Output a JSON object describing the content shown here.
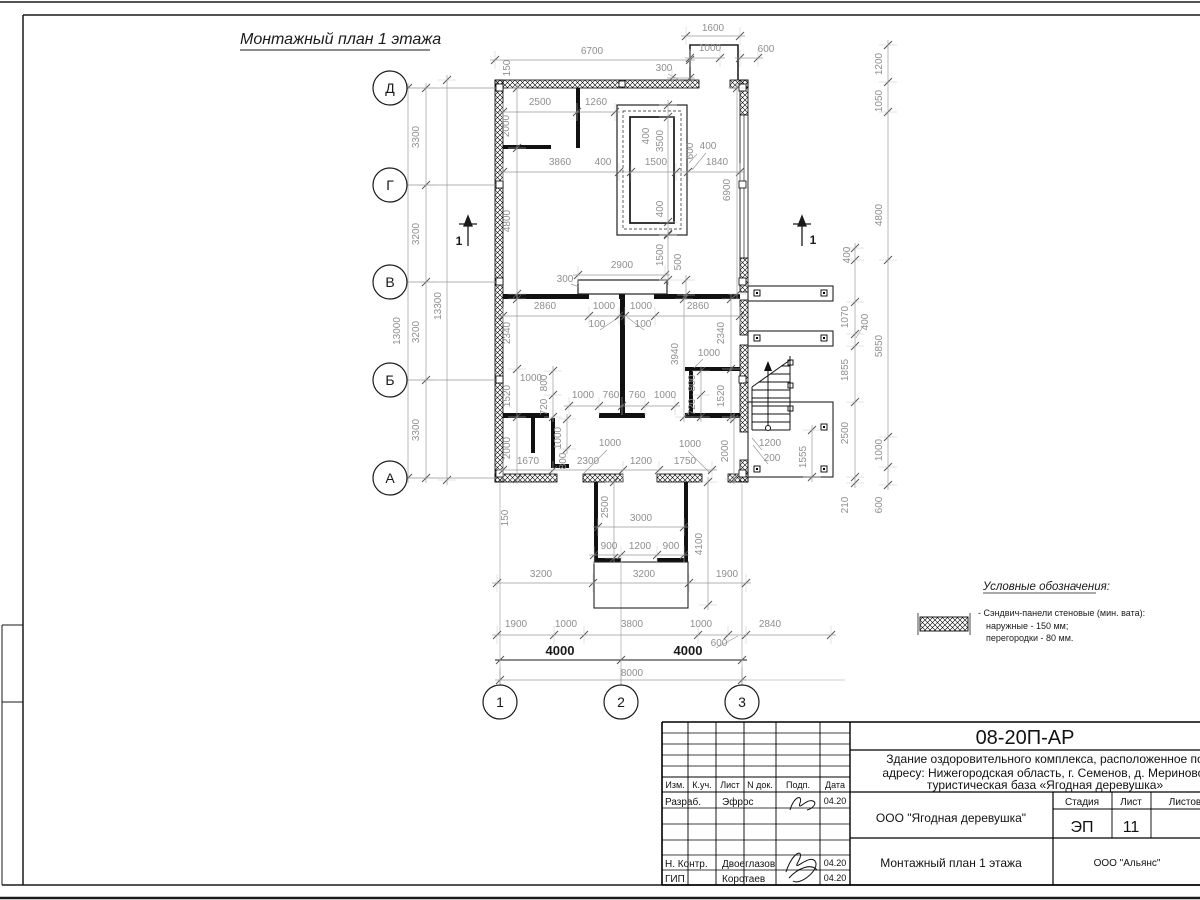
{
  "sheet": {
    "title": "Монтажный план 1 этажа"
  },
  "legend": {
    "title": "Условные обозначения:",
    "item": "- Сэндвич-панели стеновые (мин. вата):",
    "line2": "наружные - 150 мм;",
    "line3": "перегородки - 80 мм."
  },
  "title_block": {
    "code": "08-20П-АР",
    "desc1": "Здание оздоровительного комплекса, расположенное по",
    "desc2": "адресу: Нижегородская область, г. Семенов, д. Мериново,",
    "desc3": "туристическая база «Ягодная деревушка»",
    "cols": {
      "izm": "Изм.",
      "kuch": "К.уч.",
      "list": "Лист",
      "ndok": "N док.",
      "podp": "Подп.",
      "data": "Дата"
    },
    "rows": {
      "razrab": "Разраб.",
      "nkontr": "Н. Контр.",
      "gip": "ГИП"
    },
    "names": {
      "razrab": "Эфрос",
      "nkontr": "Двоеглазов",
      "gip": "Коротаев"
    },
    "dates": {
      "d1": "04.20",
      "d2": "04.20",
      "d3": "04.20"
    },
    "org": "ООО \"Ягодная деревушка\"",
    "stage_label": "Стадия",
    "sheet_label": "Лист",
    "sheets_label": "Листов",
    "stage": "ЭП",
    "sheet_num": "11",
    "plan_name": "Монтажный план 1 этажа",
    "firm": "ООО \"Альянс\""
  },
  "colors": {
    "line": "#1a1a1a",
    "dim": "#8f8f8f"
  },
  "plan": {
    "axes": {
      "rows": [
        {
          "label": "Д",
          "y": 88
        },
        {
          "label": "Г",
          "y": 185
        },
        {
          "label": "В",
          "y": 282
        },
        {
          "label": "Б",
          "y": 380
        },
        {
          "label": "А",
          "y": 478
        }
      ],
      "cols": [
        {
          "label": "1",
          "x": 500
        },
        {
          "label": "2",
          "x": 621
        },
        {
          "label": "3",
          "x": 742
        }
      ]
    },
    "chains": [
      {
        "y": 36,
        "xs": [
          686,
          740
        ]
      },
      {
        "y": 60,
        "xs": [
          495,
          690
        ]
      },
      {
        "y": 58,
        "xs": [
          690,
          720
        ]
      },
      {
        "y": 58,
        "xs": [
          740,
          758
        ]
      },
      {
        "y": 78,
        "xs": [
          672,
          690
        ]
      },
      {
        "y": 112,
        "xs": [
          503,
          577,
          615
        ]
      },
      {
        "y": 172,
        "xs": [
          503,
          619,
          631,
          676,
          688,
          740
        ]
      },
      {
        "y": 275,
        "xs": [
          578,
          665
        ]
      },
      {
        "y": 316,
        "xs": [
          503,
          589,
          619,
          625,
          655,
          740
        ]
      },
      {
        "y": 406,
        "xs": [
          569,
          599,
          622,
          645,
          675
        ]
      },
      {
        "y": 470,
        "xs": [
          503,
          553,
          623,
          659,
          712
        ]
      },
      {
        "y": 527,
        "xs": [
          598,
          684
        ]
      },
      {
        "y": 555,
        "xs": [
          594,
          621,
          657,
          684
        ]
      },
      {
        "y": 583,
        "xs": [
          497,
          593,
          689,
          746
        ]
      },
      {
        "y": 635,
        "xs": [
          497,
          554,
          584,
          698,
          728,
          746,
          831
        ]
      },
      {
        "y": 660,
        "dark": true,
        "xs": [
          500,
          621,
          742
        ]
      },
      {
        "y": 680,
        "xs": [
          500,
          742
        ]
      },
      {
        "x": 408,
        "ys": [
          88,
          478
        ]
      },
      {
        "x": 426,
        "ys": [
          88,
          185,
          282,
          380,
          478
        ]
      },
      {
        "x": 447,
        "ys": [
          80,
          480
        ]
      },
      {
        "x": 517,
        "ys": [
          88,
          148,
          294
        ]
      },
      {
        "x": 517,
        "ys": [
          299,
          369,
          417,
          479
        ]
      },
      {
        "x": 553,
        "ys": [
          371,
          395,
          417
        ]
      },
      {
        "x": 701,
        "ys": [
          371,
          395,
          417
        ]
      },
      {
        "x": 731,
        "ys": [
          299,
          369,
          417
        ]
      },
      {
        "x": 737,
        "ys": [
          88,
          294
        ]
      },
      {
        "x": 684,
        "ys": [
          299,
          417
        ]
      },
      {
        "x": 668,
        "ys": [
          105,
          117,
          222,
          234
        ]
      },
      {
        "x": 668,
        "ys": [
          235,
          280
        ]
      },
      {
        "x": 686,
        "ys": [
          280,
          295
        ]
      },
      {
        "x": 567,
        "ys": [
          419,
          449
        ]
      },
      {
        "x": 614,
        "ys": [
          482,
          558
        ]
      },
      {
        "x": 708,
        "ys": [
          482,
          605
        ]
      },
      {
        "x": 734,
        "ys": [
          419,
          479
        ]
      },
      {
        "x": 812,
        "ys": [
          430,
          477
        ]
      },
      {
        "x": 855,
        "ys": [
          248,
          260,
          302,
          334,
          346,
          402,
          477,
          483
        ]
      },
      {
        "x": 888,
        "ys": [
          45,
          82,
          112,
          260,
          437,
          467,
          485
        ]
      }
    ],
    "labels": [
      {
        "t": "1600",
        "x": 713,
        "y": 31
      },
      {
        "t": "6700",
        "x": 592,
        "y": 54
      },
      {
        "t": "1000",
        "x": 710,
        "y": 51
      },
      {
        "t": "600",
        "x": 766,
        "y": 52
      },
      {
        "t": "300",
        "x": 664,
        "y": 71
      },
      {
        "t": "150",
        "x": 510,
        "y": 68,
        "r": 1
      },
      {
        "t": "2500",
        "x": 540,
        "y": 105
      },
      {
        "t": "1260",
        "x": 596,
        "y": 105
      },
      {
        "t": "2000",
        "x": 509,
        "y": 126,
        "r": 1
      },
      {
        "t": "600",
        "x": 693,
        "y": 151,
        "r": 1
      },
      {
        "t": "3860",
        "x": 560,
        "y": 165
      },
      {
        "t": "400",
        "x": 603,
        "y": 165
      },
      {
        "t": "1500",
        "x": 656,
        "y": 165
      },
      {
        "t": "400",
        "x": 708,
        "y": 149
      },
      {
        "t": "1840",
        "x": 717,
        "y": 165
      },
      {
        "t": "400",
        "x": 649,
        "y": 136,
        "r": 1
      },
      {
        "t": "3500",
        "x": 663,
        "y": 141,
        "r": 1
      },
      {
        "t": "400",
        "x": 663,
        "y": 209,
        "r": 1
      },
      {
        "t": "4800",
        "x": 510,
        "y": 221,
        "r": 1
      },
      {
        "t": "6900",
        "x": 730,
        "y": 190,
        "r": 1
      },
      {
        "t": "2900",
        "x": 622,
        "y": 268
      },
      {
        "t": "1500",
        "x": 663,
        "y": 255,
        "r": 1
      },
      {
        "t": "500",
        "x": 681,
        "y": 262,
        "r": 1
      },
      {
        "t": "300",
        "x": 565,
        "y": 282
      },
      {
        "t": "2860",
        "x": 545,
        "y": 309
      },
      {
        "t": "1000",
        "x": 604,
        "y": 309
      },
      {
        "t": "1000",
        "x": 641,
        "y": 309
      },
      {
        "t": "2860",
        "x": 698,
        "y": 309
      },
      {
        "t": "100",
        "x": 597,
        "y": 327
      },
      {
        "t": "100",
        "x": 643,
        "y": 327
      },
      {
        "t": "2340",
        "x": 510,
        "y": 333,
        "r": 1
      },
      {
        "t": "2340",
        "x": 724,
        "y": 333,
        "r": 1
      },
      {
        "t": "3940",
        "x": 678,
        "y": 354,
        "r": 1
      },
      {
        "t": "1000",
        "x": 709,
        "y": 356
      },
      {
        "t": "1000",
        "x": 531,
        "y": 381
      },
      {
        "t": "1520",
        "x": 510,
        "y": 396,
        "r": 1
      },
      {
        "t": "1520",
        "x": 724,
        "y": 396,
        "r": 1
      },
      {
        "t": "800",
        "x": 547,
        "y": 383,
        "r": 1
      },
      {
        "t": "720",
        "x": 547,
        "y": 407,
        "r": 1
      },
      {
        "t": "800",
        "x": 695,
        "y": 383,
        "r": 1
      },
      {
        "t": "720",
        "x": 695,
        "y": 407,
        "r": 1
      },
      {
        "t": "1000",
        "x": 583,
        "y": 398
      },
      {
        "t": "760",
        "x": 611,
        "y": 398
      },
      {
        "t": "760",
        "x": 637,
        "y": 398
      },
      {
        "t": "1000",
        "x": 665,
        "y": 398
      },
      {
        "t": "2000",
        "x": 510,
        "y": 448,
        "r": 1
      },
      {
        "t": "1000",
        "x": 561,
        "y": 438,
        "r": 1
      },
      {
        "t": "800",
        "x": 566,
        "y": 461,
        "r": 1
      },
      {
        "t": "1000",
        "x": 610,
        "y": 446
      },
      {
        "t": "1000",
        "x": 690,
        "y": 447
      },
      {
        "t": "2000",
        "x": 728,
        "y": 451,
        "r": 1
      },
      {
        "t": "1670",
        "x": 528,
        "y": 464
      },
      {
        "t": "2300",
        "x": 588,
        "y": 464
      },
      {
        "t": "1200",
        "x": 641,
        "y": 464
      },
      {
        "t": "1750",
        "x": 685,
        "y": 464
      },
      {
        "t": "1200",
        "x": 770,
        "y": 446
      },
      {
        "t": "200",
        "x": 772,
        "y": 461
      },
      {
        "t": "1555",
        "x": 806,
        "y": 457,
        "r": 1
      },
      {
        "t": "150",
        "x": 508,
        "y": 518,
        "r": 1
      },
      {
        "t": "2500",
        "x": 608,
        "y": 507,
        "r": 1
      },
      {
        "t": "3000",
        "x": 641,
        "y": 521
      },
      {
        "t": "4100",
        "x": 702,
        "y": 544,
        "r": 1
      },
      {
        "t": "900",
        "x": 609,
        "y": 549
      },
      {
        "t": "1200",
        "x": 640,
        "y": 549
      },
      {
        "t": "900",
        "x": 671,
        "y": 549
      },
      {
        "t": "3200",
        "x": 541,
        "y": 577
      },
      {
        "t": "3200",
        "x": 644,
        "y": 577
      },
      {
        "t": "1900",
        "x": 727,
        "y": 577
      },
      {
        "t": "1900",
        "x": 516,
        "y": 627
      },
      {
        "t": "1000",
        "x": 566,
        "y": 627
      },
      {
        "t": "3800",
        "x": 632,
        "y": 627
      },
      {
        "t": "1000",
        "x": 701,
        "y": 627
      },
      {
        "t": "600",
        "x": 719,
        "y": 646
      },
      {
        "t": "2840",
        "x": 770,
        "y": 627
      },
      {
        "t": "4000",
        "x": 560,
        "y": 655,
        "s": 13,
        "c": "d"
      },
      {
        "t": "4000",
        "x": 688,
        "y": 655,
        "s": 13,
        "c": "d"
      },
      {
        "t": "8000",
        "x": 632,
        "y": 676
      },
      {
        "t": "13000",
        "x": 400,
        "y": 331,
        "r": 1
      },
      {
        "t": "3300",
        "x": 419,
        "y": 137,
        "r": 1
      },
      {
        "t": "3200",
        "x": 419,
        "y": 234,
        "r": 1
      },
      {
        "t": "3200",
        "x": 419,
        "y": 332,
        "r": 1
      },
      {
        "t": "3300",
        "x": 419,
        "y": 430,
        "r": 1
      },
      {
        "t": "13300",
        "x": 441,
        "y": 306,
        "r": 1
      },
      {
        "t": "1200",
        "x": 882,
        "y": 64,
        "r": 1
      },
      {
        "t": "1050",
        "x": 882,
        "y": 101,
        "r": 1
      },
      {
        "t": "4800",
        "x": 882,
        "y": 215,
        "r": 1
      },
      {
        "t": "5850",
        "x": 882,
        "y": 346,
        "r": 1
      },
      {
        "t": "1000",
        "x": 882,
        "y": 450,
        "r": 1
      },
      {
        "t": "600",
        "x": 882,
        "y": 505,
        "r": 1
      },
      {
        "t": "400",
        "x": 850,
        "y": 255,
        "r": 1
      },
      {
        "t": "1070",
        "x": 848,
        "y": 317,
        "r": 1
      },
      {
        "t": "400",
        "x": 868,
        "y": 322,
        "r": 1
      },
      {
        "t": "1855",
        "x": 848,
        "y": 370,
        "r": 1
      },
      {
        "t": "2500",
        "x": 848,
        "y": 433,
        "r": 1
      },
      {
        "t": "210",
        "x": 848,
        "y": 505,
        "r": 1
      },
      {
        "t": "1",
        "x": 459,
        "y": 245,
        "s": 12,
        "c": "d"
      },
      {
        "t": "1",
        "x": 813,
        "y": 244,
        "s": 12,
        "c": "d"
      }
    ]
  }
}
